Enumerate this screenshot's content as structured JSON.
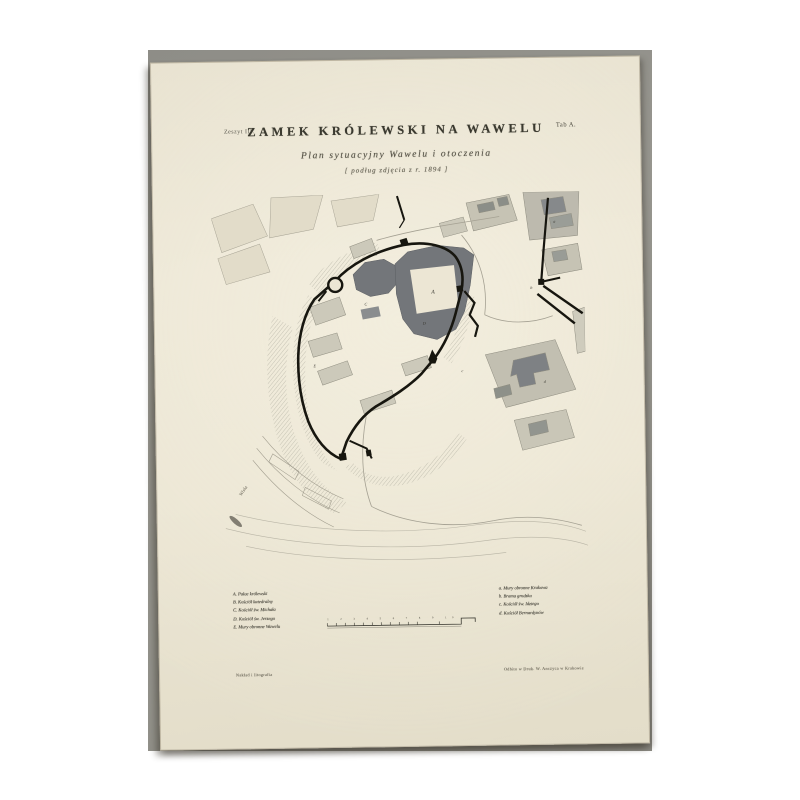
{
  "header": {
    "edition": "Zeszyt III.",
    "plate": "Tab A.",
    "title": "ZAMEK KRÓLEWSKI NA WAWELU",
    "subtitle": "Plan sytuacyjny Wawelu i otoczenia",
    "subtitle_note": "[ podług zdjęcia z r. 1894 ]"
  },
  "map": {
    "river_label": "Wisła",
    "letters": {
      "palace": "A",
      "cathedral": "B",
      "st_michael": "C",
      "st_george": "D",
      "walls": "E",
      "city_walls": "a",
      "gate": "b",
      "st_giles": "c",
      "bernardine": "d"
    }
  },
  "legend": {
    "left": [
      "A. Pałac królewski",
      "B. Kościół katedralny",
      "C. Kościół św. Michała",
      "D. Kościół św. Jerzego",
      "E. Mury obronne Wawelu"
    ],
    "right": [
      "a. Mury obronne Krakowa",
      "b. Brama grodzka",
      "c. Kościół św. Idziego",
      "d. Kościół Bernardynów"
    ]
  },
  "scale_bar": {
    "numbers": "1 2 3 4 5 6 7 8 9 10"
  },
  "imprints": {
    "left": "Nakład i litografia",
    "right": "Odbito w Druk. W. Anczyca w Krakowie"
  },
  "colors": {
    "photo_bg": "#93928b",
    "paper": "#eae4d2",
    "ink": "#35342c",
    "wall_black": "#17160f",
    "building_dark": "#73767a",
    "building_light": "#ccc9ba",
    "hatch": "#aaa79a"
  }
}
